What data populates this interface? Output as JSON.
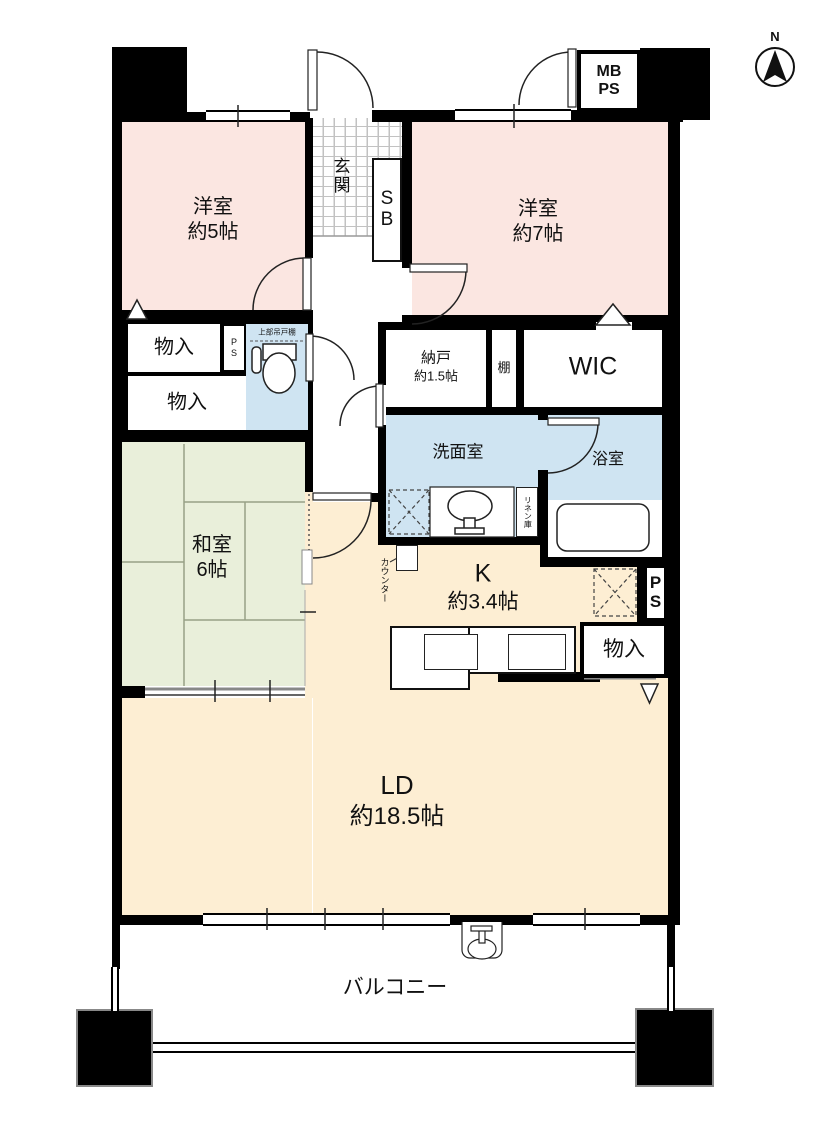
{
  "palette": {
    "wall": "#000000",
    "western_room": "#fbe6e1",
    "japanese_room": "#e9efda",
    "wet_room": "#cfe4f2",
    "living_room": "#fdeed3"
  },
  "compass": {
    "north": "N"
  },
  "rooms": {
    "western5": {
      "name": "洋室",
      "size": "約5帖"
    },
    "western7": {
      "name": "洋室",
      "size": "約7帖"
    },
    "japanese": {
      "name": "和室",
      "size": "6帖"
    },
    "living": {
      "name": "LD",
      "size": "約18.5帖"
    },
    "kitchen": {
      "name": "K",
      "size": "約3.4帖"
    },
    "entrance": {
      "name": "玄関"
    },
    "washroom": {
      "name": "洗面室"
    },
    "bathroom": {
      "name": "浴室"
    },
    "storeroom": {
      "name": "納戸",
      "size": "約1.5帖"
    },
    "wic": {
      "name": "WIC"
    },
    "balcony": {
      "name": "バルコニー"
    }
  },
  "closets": {
    "storage1": {
      "label": "物入"
    },
    "storage2": {
      "label": "物入"
    },
    "storage3": {
      "label": "物入"
    },
    "shoe_box": {
      "line1": "S",
      "line2": "B"
    },
    "shelf": {
      "label": "棚"
    },
    "linen": {
      "label": "リネン庫"
    },
    "upper_cabinet": {
      "label": "上部吊戸棚"
    },
    "counter": {
      "label": "カウンター"
    }
  },
  "shafts": {
    "mb_ps": {
      "line1": "MB",
      "line2": "PS"
    },
    "ps_toilet": {
      "label": "PS"
    },
    "ps_kitchen": {
      "line1": "P",
      "line2": "S"
    }
  }
}
